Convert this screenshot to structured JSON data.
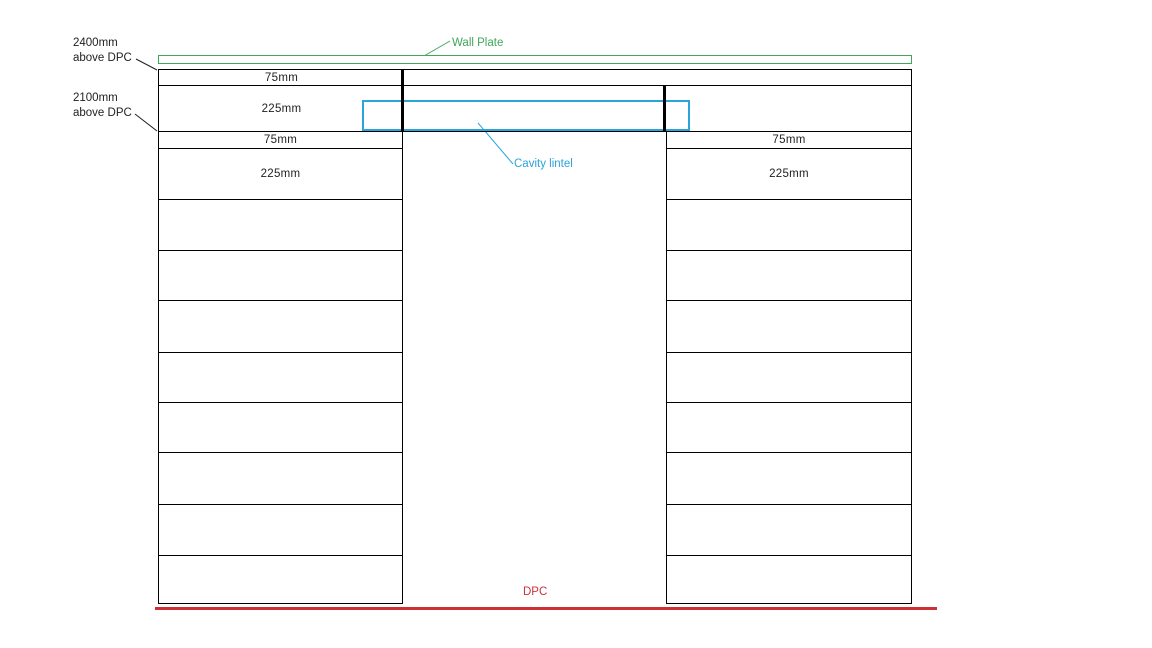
{
  "colors": {
    "wall_plate_green": "#3FA75C",
    "lintel_cyan": "#2BA4DB",
    "dpc_red": "#CE3038",
    "line_black": "#000000",
    "text": "#1F1F1F"
  },
  "annotations": {
    "dim_2400": {
      "line1": "2400mm",
      "line2": "above DPC"
    },
    "dim_2100": {
      "line1": "2100mm",
      "line2": "above DPC"
    },
    "wall_plate_label": "Wall Plate",
    "cavity_lintel_label": "Cavity lintel",
    "dpc_label": "DPC"
  },
  "wall": {
    "full_width_courses": [
      {
        "label": "75mm",
        "y": 69,
        "h": 17
      },
      {
        "label": "225mm",
        "y": 86,
        "h": 46
      }
    ],
    "left_column_courses": [
      {
        "label": "75mm",
        "y": 132,
        "h": 17
      },
      {
        "label": "225mm",
        "y": 149,
        "h": 51
      },
      {
        "label": "",
        "y": 200,
        "h": 51
      },
      {
        "label": "",
        "y": 251,
        "h": 50
      },
      {
        "label": "",
        "y": 301,
        "h": 52
      },
      {
        "label": "",
        "y": 353,
        "h": 50
      },
      {
        "label": "",
        "y": 403,
        "h": 50
      },
      {
        "label": "",
        "y": 453,
        "h": 52
      },
      {
        "label": "",
        "y": 505,
        "h": 51
      },
      {
        "label": "",
        "y": 556,
        "h": 48
      }
    ],
    "right_column_courses": [
      {
        "label": "75mm",
        "y": 132,
        "h": 17
      },
      {
        "label": "225mm",
        "y": 149,
        "h": 51
      },
      {
        "label": "",
        "y": 200,
        "h": 51
      },
      {
        "label": "",
        "y": 251,
        "h": 50
      },
      {
        "label": "",
        "y": 301,
        "h": 52
      },
      {
        "label": "",
        "y": 353,
        "h": 50
      },
      {
        "label": "",
        "y": 403,
        "h": 50
      },
      {
        "label": "",
        "y": 453,
        "h": 52
      },
      {
        "label": "",
        "y": 505,
        "h": 51
      },
      {
        "label": "",
        "y": 556,
        "h": 48
      }
    ]
  },
  "geometry": {
    "wall_plate": {
      "x": 158,
      "y": 55,
      "w": 754,
      "h": 9
    },
    "full_rows": {
      "x": 158,
      "w": 754,
      "label_w": 245
    },
    "left_col": {
      "x": 158,
      "w": 245
    },
    "right_col": {
      "x": 666,
      "w": 246
    },
    "left_jamb": {
      "x": 401,
      "y": 69,
      "w": 3,
      "h": 63
    },
    "right_jamb": {
      "x": 663,
      "y": 86,
      "w": 3,
      "h": 46
    },
    "lintel": {
      "x": 362,
      "y": 100,
      "w": 328,
      "h": 31
    },
    "dpc_line": {
      "x": 155,
      "y": 607,
      "w": 782,
      "h": 3
    },
    "labels": {
      "dim_2400": {
        "x": 73,
        "y": 36
      },
      "dim_2100": {
        "x": 73,
        "y": 91
      },
      "wall_plate": {
        "x": 452,
        "y": 36
      },
      "cavity_lintel": {
        "x": 514,
        "y": 157
      },
      "dpc": {
        "x": 523,
        "y": 585
      }
    }
  }
}
